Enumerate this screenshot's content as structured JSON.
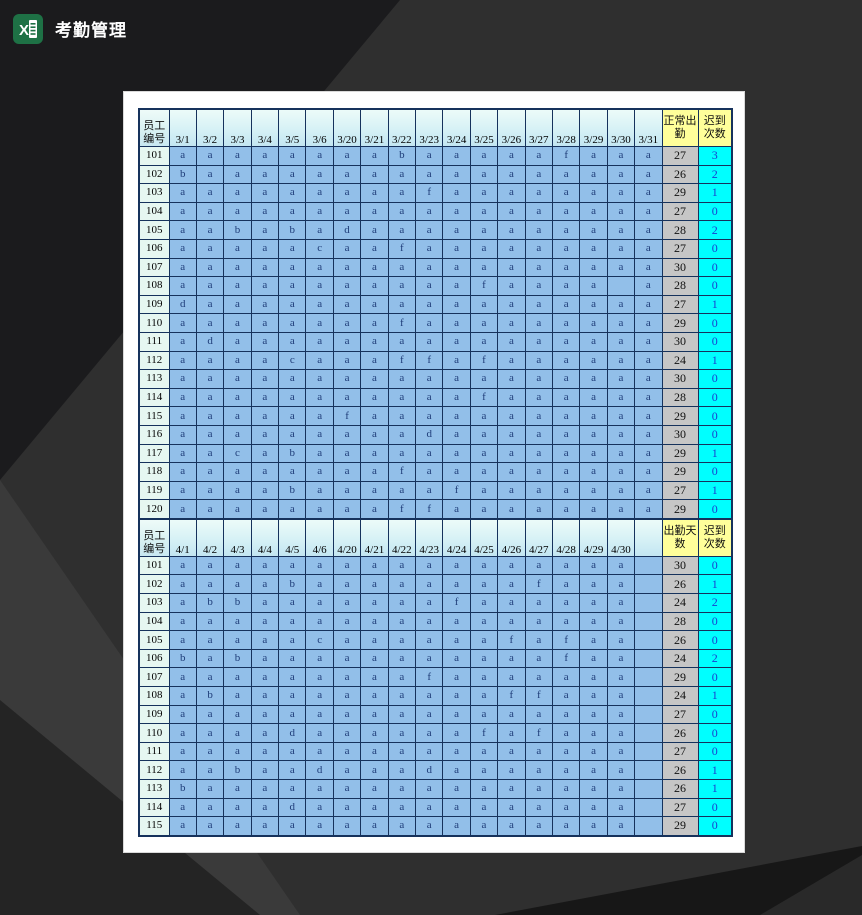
{
  "window": {
    "title": "考勤管理"
  },
  "colors": {
    "excel_green": "#1e7145",
    "cell_blue": "#92bfe9",
    "header_yellow": "#ffff9a",
    "late_cyan": "#00ffff",
    "attendance_gray": "#c6c6c6",
    "grid_navy": "#16325c",
    "background_dark": "#2f2f2f"
  },
  "sheet": {
    "tables": [
      {
        "id_header": "员工编号",
        "dates": [
          "3/1",
          "3/2",
          "3/3",
          "3/4",
          "3/5",
          "3/6",
          "3/20",
          "3/21",
          "3/22",
          "3/23",
          "3/24",
          "3/25",
          "3/26",
          "3/27",
          "3/28",
          "3/29",
          "3/30",
          "3/31"
        ],
        "summary_headers": [
          "正常出勤",
          "迟到次数"
        ],
        "rows": [
          {
            "id": "101",
            "cells": [
              "a",
              "a",
              "a",
              "a",
              "a",
              "a",
              "a",
              "a",
              "b",
              "a",
              "a",
              "a",
              "a",
              "a",
              "f",
              "a",
              "a",
              "a"
            ],
            "attendance": "27",
            "late": "3"
          },
          {
            "id": "102",
            "cells": [
              "b",
              "a",
              "a",
              "a",
              "a",
              "a",
              "a",
              "a",
              "a",
              "a",
              "a",
              "a",
              "a",
              "a",
              "a",
              "a",
              "a",
              "a"
            ],
            "attendance": "26",
            "late": "2"
          },
          {
            "id": "103",
            "cells": [
              "a",
              "a",
              "a",
              "a",
              "a",
              "a",
              "a",
              "a",
              "a",
              "f",
              "a",
              "a",
              "a",
              "a",
              "a",
              "a",
              "a",
              "a"
            ],
            "attendance": "29",
            "late": "1"
          },
          {
            "id": "104",
            "cells": [
              "a",
              "a",
              "a",
              "a",
              "a",
              "a",
              "a",
              "a",
              "a",
              "a",
              "a",
              "a",
              "a",
              "a",
              "a",
              "a",
              "a",
              "a"
            ],
            "attendance": "27",
            "late": "0"
          },
          {
            "id": "105",
            "cells": [
              "a",
              "a",
              "b",
              "a",
              "b",
              "a",
              "d",
              "a",
              "a",
              "a",
              "a",
              "a",
              "a",
              "a",
              "a",
              "a",
              "a",
              "a"
            ],
            "attendance": "28",
            "late": "2"
          },
          {
            "id": "106",
            "cells": [
              "a",
              "a",
              "a",
              "a",
              "a",
              "c",
              "a",
              "a",
              "f",
              "a",
              "a",
              "a",
              "a",
              "a",
              "a",
              "a",
              "a",
              "a"
            ],
            "attendance": "27",
            "late": "0"
          },
          {
            "id": "107",
            "cells": [
              "a",
              "a",
              "a",
              "a",
              "a",
              "a",
              "a",
              "a",
              "a",
              "a",
              "a",
              "a",
              "a",
              "a",
              "a",
              "a",
              "a",
              "a"
            ],
            "attendance": "30",
            "late": "0"
          },
          {
            "id": "108",
            "cells": [
              "a",
              "a",
              "a",
              "a",
              "a",
              "a",
              "a",
              "a",
              "a",
              "a",
              "a",
              "f",
              "a",
              "a",
              "a",
              "a",
              "",
              "a"
            ],
            "attendance": "28",
            "late": "0"
          },
          {
            "id": "109",
            "cells": [
              "d",
              "a",
              "a",
              "a",
              "a",
              "a",
              "a",
              "a",
              "a",
              "a",
              "a",
              "a",
              "a",
              "a",
              "a",
              "a",
              "a",
              "a"
            ],
            "attendance": "27",
            "late": "1"
          },
          {
            "id": "110",
            "cells": [
              "a",
              "a",
              "a",
              "a",
              "a",
              "a",
              "a",
              "a",
              "f",
              "a",
              "a",
              "a",
              "a",
              "a",
              "a",
              "a",
              "a",
              "a"
            ],
            "attendance": "29",
            "late": "0"
          },
          {
            "id": "111",
            "cells": [
              "a",
              "d",
              "a",
              "a",
              "a",
              "a",
              "a",
              "a",
              "a",
              "a",
              "a",
              "a",
              "a",
              "a",
              "a",
              "a",
              "a",
              "a"
            ],
            "attendance": "30",
            "late": "0"
          },
          {
            "id": "112",
            "cells": [
              "a",
              "a",
              "a",
              "a",
              "c",
              "a",
              "a",
              "a",
              "f",
              "f",
              "a",
              "f",
              "a",
              "a",
              "a",
              "a",
              "a",
              "a"
            ],
            "attendance": "24",
            "late": "1"
          },
          {
            "id": "113",
            "cells": [
              "a",
              "a",
              "a",
              "a",
              "a",
              "a",
              "a",
              "a",
              "a",
              "a",
              "a",
              "a",
              "a",
              "a",
              "a",
              "a",
              "a",
              "a"
            ],
            "attendance": "30",
            "late": "0"
          },
          {
            "id": "114",
            "cells": [
              "a",
              "a",
              "a",
              "a",
              "a",
              "a",
              "a",
              "a",
              "a",
              "a",
              "a",
              "f",
              "a",
              "a",
              "a",
              "a",
              "a",
              "a"
            ],
            "attendance": "28",
            "late": "0"
          },
          {
            "id": "115",
            "cells": [
              "a",
              "a",
              "a",
              "a",
              "a",
              "a",
              "f",
              "a",
              "a",
              "a",
              "a",
              "a",
              "a",
              "a",
              "a",
              "a",
              "a",
              "a"
            ],
            "attendance": "29",
            "late": "0"
          },
          {
            "id": "116",
            "cells": [
              "a",
              "a",
              "a",
              "a",
              "a",
              "a",
              "a",
              "a",
              "a",
              "d",
              "a",
              "a",
              "a",
              "a",
              "a",
              "a",
              "a",
              "a"
            ],
            "attendance": "30",
            "late": "0"
          },
          {
            "id": "117",
            "cells": [
              "a",
              "a",
              "c",
              "a",
              "b",
              "a",
              "a",
              "a",
              "a",
              "a",
              "a",
              "a",
              "a",
              "a",
              "a",
              "a",
              "a",
              "a"
            ],
            "attendance": "29",
            "late": "1"
          },
          {
            "id": "118",
            "cells": [
              "a",
              "a",
              "a",
              "a",
              "a",
              "a",
              "a",
              "a",
              "f",
              "a",
              "a",
              "a",
              "a",
              "a",
              "a",
              "a",
              "a",
              "a"
            ],
            "attendance": "29",
            "late": "0"
          },
          {
            "id": "119",
            "cells": [
              "a",
              "a",
              "a",
              "a",
              "b",
              "a",
              "a",
              "a",
              "a",
              "a",
              "f",
              "a",
              "a",
              "a",
              "a",
              "a",
              "a",
              "a"
            ],
            "attendance": "27",
            "late": "1"
          },
          {
            "id": "120",
            "cells": [
              "a",
              "a",
              "a",
              "a",
              "a",
              "a",
              "a",
              "a",
              "f",
              "f",
              "a",
              "a",
              "a",
              "a",
              "a",
              "a",
              "a",
              "a"
            ],
            "attendance": "29",
            "late": "0"
          }
        ]
      },
      {
        "id_header": "员工编号",
        "dates": [
          "4/1",
          "4/2",
          "4/3",
          "4/4",
          "4/5",
          "4/6",
          "4/20",
          "4/21",
          "4/22",
          "4/23",
          "4/24",
          "4/25",
          "4/26",
          "4/27",
          "4/28",
          "4/29",
          "4/30",
          ""
        ],
        "summary_headers": [
          "出勤天数",
          "迟到次数"
        ],
        "rows": [
          {
            "id": "101",
            "cells": [
              "a",
              "a",
              "a",
              "a",
              "a",
              "a",
              "a",
              "a",
              "a",
              "a",
              "a",
              "a",
              "a",
              "a",
              "a",
              "a",
              "a",
              ""
            ],
            "attendance": "30",
            "late": "0"
          },
          {
            "id": "102",
            "cells": [
              "a",
              "a",
              "a",
              "a",
              "b",
              "a",
              "a",
              "a",
              "a",
              "a",
              "a",
              "a",
              "a",
              "f",
              "a",
              "a",
              "a",
              ""
            ],
            "attendance": "26",
            "late": "1"
          },
          {
            "id": "103",
            "cells": [
              "a",
              "b",
              "b",
              "a",
              "a",
              "a",
              "a",
              "a",
              "a",
              "a",
              "f",
              "a",
              "a",
              "a",
              "a",
              "a",
              "a",
              ""
            ],
            "attendance": "24",
            "late": "2"
          },
          {
            "id": "104",
            "cells": [
              "a",
              "a",
              "a",
              "a",
              "a",
              "a",
              "a",
              "a",
              "a",
              "a",
              "a",
              "a",
              "a",
              "a",
              "a",
              "a",
              "a",
              ""
            ],
            "attendance": "28",
            "late": "0"
          },
          {
            "id": "105",
            "cells": [
              "a",
              "a",
              "a",
              "a",
              "a",
              "c",
              "a",
              "a",
              "a",
              "a",
              "a",
              "a",
              "f",
              "a",
              "f",
              "a",
              "a",
              ""
            ],
            "attendance": "26",
            "late": "0"
          },
          {
            "id": "106",
            "cells": [
              "b",
              "a",
              "b",
              "a",
              "a",
              "a",
              "a",
              "a",
              "a",
              "a",
              "a",
              "a",
              "a",
              "a",
              "f",
              "a",
              "a",
              ""
            ],
            "attendance": "24",
            "late": "2"
          },
          {
            "id": "107",
            "cells": [
              "a",
              "a",
              "a",
              "a",
              "a",
              "a",
              "a",
              "a",
              "a",
              "f",
              "a",
              "a",
              "a",
              "a",
              "a",
              "a",
              "a",
              ""
            ],
            "attendance": "29",
            "late": "0"
          },
          {
            "id": "108",
            "cells": [
              "a",
              "b",
              "a",
              "a",
              "a",
              "a",
              "a",
              "a",
              "a",
              "a",
              "a",
              "a",
              "f",
              "f",
              "a",
              "a",
              "a",
              ""
            ],
            "attendance": "24",
            "late": "1"
          },
          {
            "id": "109",
            "cells": [
              "a",
              "a",
              "a",
              "a",
              "a",
              "a",
              "a",
              "a",
              "a",
              "a",
              "a",
              "a",
              "a",
              "a",
              "a",
              "a",
              "a",
              ""
            ],
            "attendance": "27",
            "late": "0"
          },
          {
            "id": "110",
            "cells": [
              "a",
              "a",
              "a",
              "a",
              "d",
              "a",
              "a",
              "a",
              "a",
              "a",
              "a",
              "f",
              "a",
              "f",
              "a",
              "a",
              "a",
              ""
            ],
            "attendance": "26",
            "late": "0"
          },
          {
            "id": "111",
            "cells": [
              "a",
              "a",
              "a",
              "a",
              "a",
              "a",
              "a",
              "a",
              "a",
              "a",
              "a",
              "a",
              "a",
              "a",
              "a",
              "a",
              "a",
              ""
            ],
            "attendance": "27",
            "late": "0"
          },
          {
            "id": "112",
            "cells": [
              "a",
              "a",
              "b",
              "a",
              "a",
              "d",
              "a",
              "a",
              "a",
              "d",
              "a",
              "a",
              "a",
              "a",
              "a",
              "a",
              "a",
              ""
            ],
            "attendance": "26",
            "late": "1"
          },
          {
            "id": "113",
            "cells": [
              "b",
              "a",
              "a",
              "a",
              "a",
              "a",
              "a",
              "a",
              "a",
              "a",
              "a",
              "a",
              "a",
              "a",
              "a",
              "a",
              "a",
              ""
            ],
            "attendance": "26",
            "late": "1"
          },
          {
            "id": "114",
            "cells": [
              "a",
              "a",
              "a",
              "a",
              "d",
              "a",
              "a",
              "a",
              "a",
              "a",
              "a",
              "a",
              "a",
              "a",
              "a",
              "a",
              "a",
              ""
            ],
            "attendance": "27",
            "late": "0"
          },
          {
            "id": "115",
            "cells": [
              "a",
              "a",
              "a",
              "a",
              "a",
              "a",
              "a",
              "a",
              "a",
              "a",
              "a",
              "a",
              "a",
              "a",
              "a",
              "a",
              "a",
              ""
            ],
            "attendance": "29",
            "late": "0"
          }
        ]
      }
    ]
  }
}
